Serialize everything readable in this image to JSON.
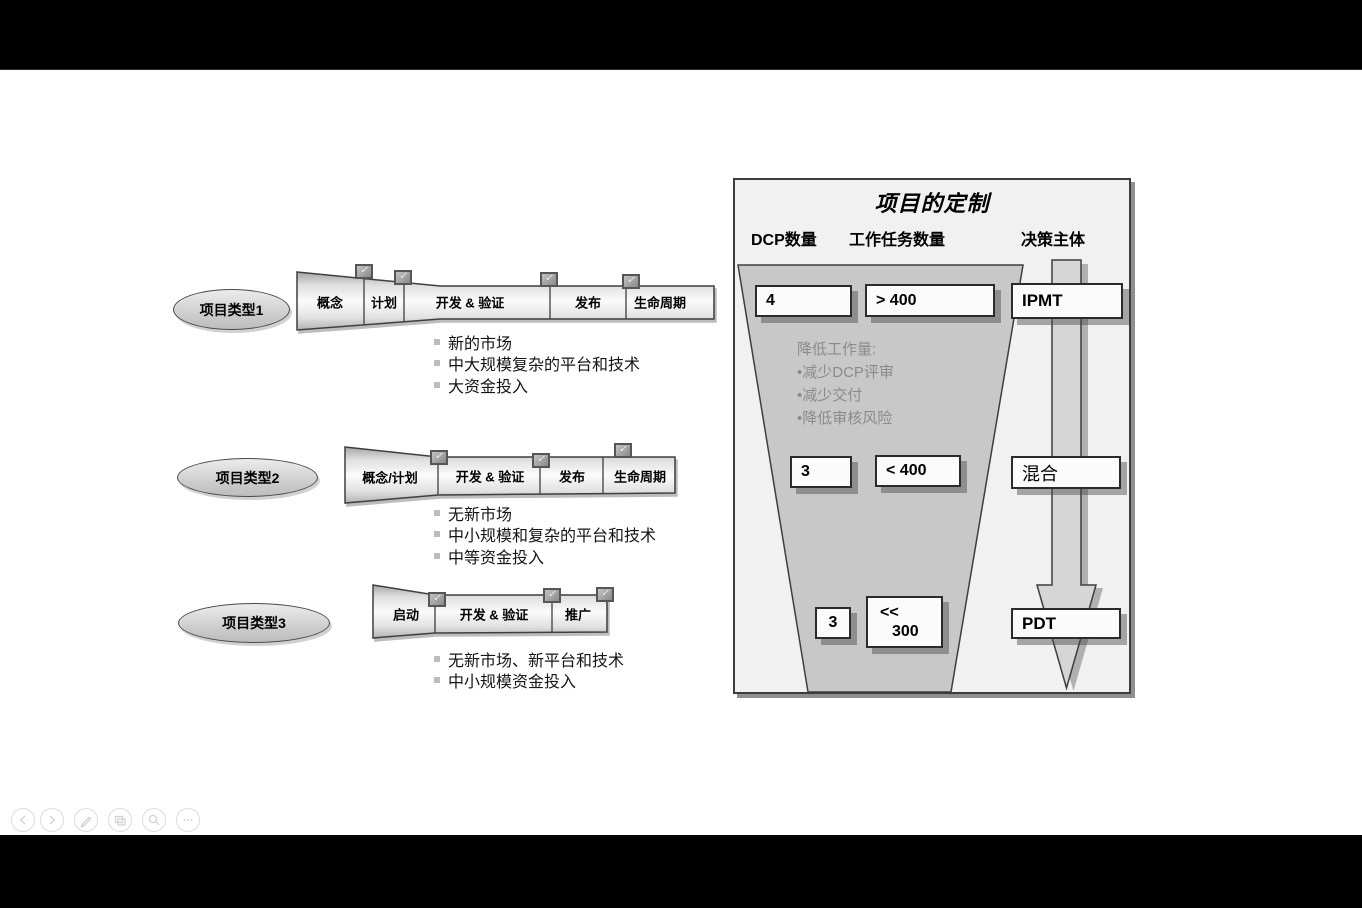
{
  "colors": {
    "letterbox": "#000000",
    "slide_bg": "#ffffff",
    "panel_bg": "#f1f1f1",
    "funnel_fill": "#c8c8c8",
    "muted_text": "#8b8b8b",
    "outline": "#3f3f3f"
  },
  "icons": {
    "check": "✓"
  },
  "types": [
    {
      "label": "项目类型1",
      "stages": [
        "概念",
        "计划",
        "开发 & 验证",
        "发布",
        "生命周期"
      ],
      "bullets": [
        "新的市场",
        "中大规模复杂的平台和技术",
        "大资金投入"
      ]
    },
    {
      "label": "项目类型2",
      "stages": [
        "概念/计划",
        "开发 & 验证",
        "发布",
        "生命周期"
      ],
      "bullets": [
        "无新市场",
        "中小规模和复杂的平台和技术",
        "中等资金投入"
      ]
    },
    {
      "label": "项目类型3",
      "stages": [
        "启动",
        "开发 & 验证",
        "推广"
      ],
      "bullets": [
        "无新市场、新平台和技术",
        "中小规模资金投入"
      ]
    }
  ],
  "panel": {
    "title": "项目的定制",
    "headers": [
      "DCP数量",
      "工作任务数量",
      "决策主体"
    ],
    "note": {
      "title": "降低工作量:",
      "items": [
        "•减少DCP评审",
        "•减少交付",
        "•降低审核风险"
      ]
    },
    "rows": [
      {
        "dcp": "4",
        "workload": "> 400",
        "decision": "IPMT"
      },
      {
        "dcp": "3",
        "workload": "< 400",
        "decision": "混合"
      },
      {
        "dcp": "3",
        "workload_top": "<<",
        "workload_bottom": "300",
        "decision": "PDT"
      }
    ]
  },
  "toolbar": {
    "buttons": [
      "previous-slide",
      "next-slide",
      "pen-annotate",
      "slide-thumbnails",
      "zoom",
      "more-options"
    ]
  }
}
